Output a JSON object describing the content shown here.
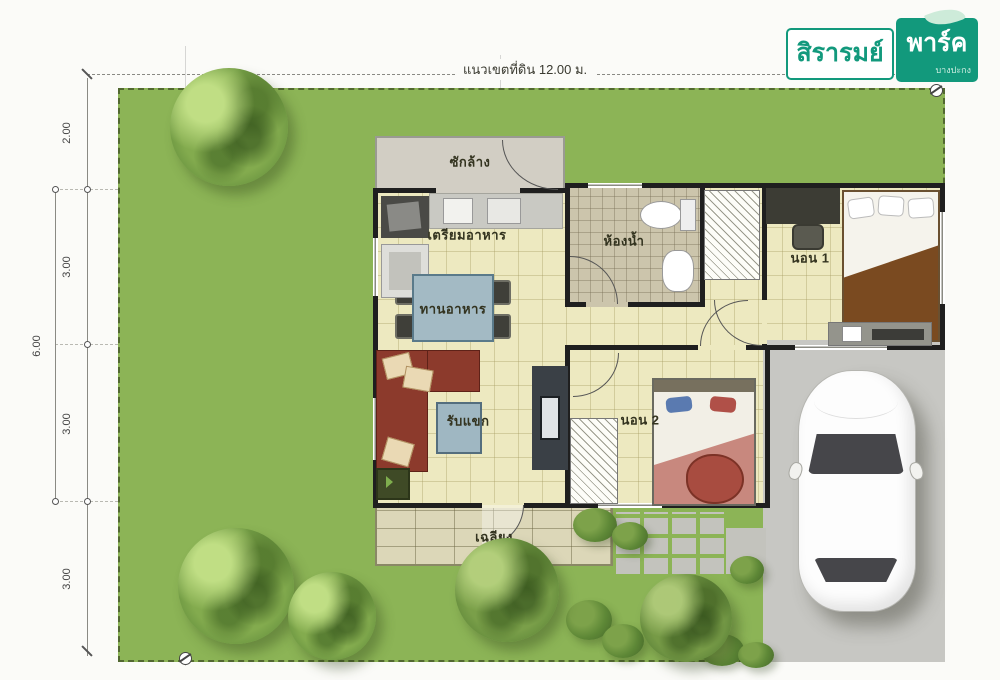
{
  "logo": {
    "name": "สิรารมย์",
    "park": "พาร์ค",
    "sub": "บางปะกง"
  },
  "dimensions": {
    "top_label": "แนวเขตที่ดิน 12.00 ม.",
    "left": [
      "2.00",
      "3.00",
      "3.00",
      "3.00"
    ],
    "left_outer": "6.00"
  },
  "rooms": {
    "laundry": {
      "label": "ซักล้าง"
    },
    "kitchen": {
      "label": "เตรียมอาหาร"
    },
    "dining": {
      "label": "ทานอาหาร"
    },
    "living": {
      "label": "รับแขก"
    },
    "bathroom": {
      "label": "ห้องน้ำ"
    },
    "bedroom1": {
      "label": "นอน 1"
    },
    "bedroom2": {
      "label": "นอน 2"
    },
    "terrace": {
      "label": "เฉลียง"
    }
  },
  "colors": {
    "lawn": "#8cb456",
    "wall": "#1f1f1f",
    "interior": "#ede9c0",
    "laundryFloor": "#d2cec4",
    "bathFloor": "#ccc5ac",
    "terrace": "#dcd7b8",
    "driveway": "#c7c7c3",
    "sofa": "#8c3a2c",
    "diningTable": "#a3bac4",
    "tvCabinet": "#3a4046",
    "bed1Blanket": "#7a4a20",
    "bed2Blanket": "#c8887e",
    "tree": "#6f9c41",
    "logoGreen": "#12997c"
  }
}
